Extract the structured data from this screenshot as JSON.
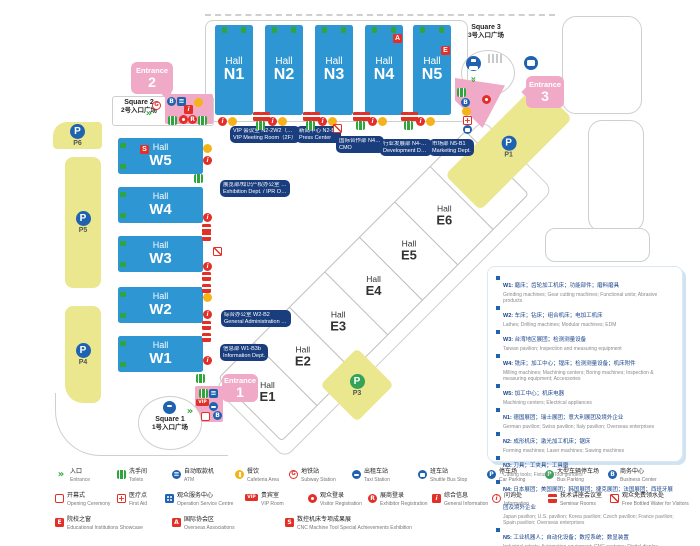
{
  "halls": {
    "n": [
      {
        "hall": "Hall",
        "code": "N1"
      },
      {
        "hall": "Hall",
        "code": "N2"
      },
      {
        "hall": "Hall",
        "code": "N3"
      },
      {
        "hall": "Hall",
        "code": "N4"
      },
      {
        "hall": "Hall",
        "code": "N5"
      }
    ],
    "w": [
      {
        "hall": "Hall",
        "code": "W5"
      },
      {
        "hall": "Hall",
        "code": "W4"
      },
      {
        "hall": "Hall",
        "code": "W3"
      },
      {
        "hall": "Hall",
        "code": "W2"
      },
      {
        "hall": "Hall",
        "code": "W1"
      }
    ],
    "e": [
      {
        "hall": "Hall",
        "code": "E1"
      },
      {
        "hall": "Hall",
        "code": "E2"
      },
      {
        "hall": "Hall",
        "code": "E3"
      },
      {
        "hall": "Hall",
        "code": "E4"
      },
      {
        "hall": "Hall",
        "code": "E5"
      },
      {
        "hall": "Hall",
        "code": "E6"
      },
      {
        "hall": "Hall",
        "code": "E7"
      }
    ]
  },
  "badges": {
    "n4": "A",
    "n5": "E",
    "w5": "S"
  },
  "entrances": [
    {
      "word": "Entrance",
      "num": "1"
    },
    {
      "word": "Entrance",
      "num": "2"
    },
    {
      "word": "Entrance",
      "num": "3"
    }
  ],
  "squares": [
    {
      "en": "Square 1",
      "cn": "1号入口广场"
    },
    {
      "en": "Square 2",
      "cn": "2号入口广场"
    },
    {
      "en": "Square 3",
      "cn": "3号入口广场"
    }
  ],
  "parking": [
    {
      "code": "P1"
    },
    {
      "code": "P3"
    },
    {
      "code": "P4"
    },
    {
      "code": "P5"
    },
    {
      "code": "P6"
    }
  ],
  "callouts": [
    {
      "cn": "VIP 会议室 N2-2W2（二层）",
      "en": "VIP Meeting Room（2F）"
    },
    {
      "cn": "新闻中心 N2-B1",
      "en": "Press Center"
    },
    {
      "cn": "国际合作部 N4-M4",
      "en": "CMO"
    },
    {
      "cn": "行业发展部 N4-B2c",
      "en": "Development Dept."
    },
    {
      "cn": "市场部 N5-B1",
      "en": "Marketing Dept."
    },
    {
      "cn": "展览部/知识产权办公室 W5-M8",
      "en": "Exhibition Dept. / IPR Office"
    },
    {
      "cn": "综合办公室 W2-B2",
      "en": "General Administration Office"
    },
    {
      "cn": "信息部 W1-B3b",
      "en": "Information Dept."
    }
  ],
  "info_panel": {
    "items": [
      {
        "code": "W1:",
        "cn": "磨床；齿轮加工机床；功能部件；磨料磨具",
        "en": "Grinding machines; Gear cutting machines; Functional units; Abrasive products"
      },
      {
        "code": "W2:",
        "cn": "车床；钻床；组合机床；电加工机床",
        "en": "Lathes; Drilling machines; Modular machines; EDM"
      },
      {
        "code": "W3:",
        "cn": "台湾地区展团；检测测量设备",
        "en": "Taiwan pavilion; Inspection and measuring equipment"
      },
      {
        "code": "W4:",
        "cn": "铣床；加工中心；镗床；检测测量设备；机床附件",
        "en": "Milling machines; Machining centers; Boring machines; Inspection & measuring equipment; Accessories"
      },
      {
        "code": "W5:",
        "cn": "加工中心；机床电器",
        "en": "Machining centers; Electrical appliances"
      },
      {
        "code": "N1:",
        "cn": "德国展团；瑞士展团；意大利展团及境外企业",
        "en": "German pavilion; Swiss pavilion; Italy pavilion; Overseas enterprises"
      },
      {
        "code": "N2:",
        "cn": "成形机床；激光加工机床；锯床",
        "en": "Forming machines; Laser machines; Sawing machines"
      },
      {
        "code": "N3:",
        "cn": "刀具；工夹具；工具磨",
        "en": "Cutting tools; Fixtures; Tool grinders"
      },
      {
        "code": "N4:",
        "cn": "日本展团；美国展团；韩国展团；捷克展团；法国展团；西班牙展团及境外企业",
        "en": "Japan pavilion; U.S. pavilion; Korea pavilion; Czech pavilion; France pavilion; Spain pavilion; Overseas enterprises"
      },
      {
        "code": "N5:",
        "cn": "工业机器人；自动化设备；数控系统；数显装置",
        "en": "Industrial robots; Automation equipment; CNC systems; Digital display"
      }
    ]
  },
  "legend": {
    "row1": [
      {
        "icon": "entrance-arrows",
        "cn": "入口",
        "en": "Entrance"
      },
      {
        "icon": "toilets",
        "cn": "洗手间",
        "en": "Toilets"
      },
      {
        "icon": "atm",
        "cn": "自动取款机",
        "en": "ATM"
      },
      {
        "icon": "cafeteria",
        "cn": "餐饮",
        "en": "Cafeteria Area"
      },
      {
        "icon": "subway",
        "cn": "地铁站",
        "en": "Subway Station"
      },
      {
        "icon": "taxi",
        "cn": "出租车站",
        "en": "Taxi Station"
      },
      {
        "icon": "shuttle-bus",
        "cn": "班车站",
        "en": "Shuttle Bus Stop"
      },
      {
        "icon": "car-parking",
        "cn": "停车场",
        "en": "Car Parking"
      },
      {
        "icon": "bus-parking",
        "cn": "大型车辆停车场",
        "en": "Bus Parking"
      },
      {
        "icon": "business-center",
        "cn": "商务中心",
        "en": "Business Center"
      }
    ],
    "row2": [
      {
        "icon": "opening-ceremony",
        "cn": "开幕式",
        "en": "Opening Ceremony"
      },
      {
        "icon": "first-aid",
        "cn": "医疗点",
        "en": "First Aid"
      },
      {
        "icon": "service-centre",
        "cn": "观众服务中心",
        "en": "Operation Service Centre"
      },
      {
        "icon": "vip-room",
        "cn": "贵宾室",
        "en": "VIP Room"
      },
      {
        "icon": "visitor-registration",
        "cn": "观众登录",
        "en": "Visitor Registration"
      },
      {
        "icon": "exhibitor-registration",
        "cn": "展商登录",
        "en": "Exhibitor Registration"
      },
      {
        "icon": "general-information",
        "cn": "综合信息",
        "en": "General Information"
      },
      {
        "icon": "information",
        "cn": "问询处",
        "en": "Information"
      },
      {
        "icon": "seminar-rooms",
        "cn": "技术讲座会议室",
        "en": "Seminar Rooms"
      },
      {
        "icon": "free-water",
        "cn": "观众免费领水处",
        "en": "Free Bottled Water for Visitors"
      }
    ],
    "row3": [
      {
        "icon": "educational",
        "cn": "院校之窗",
        "en": "Educational Institutions Showcase"
      },
      {
        "icon": "overseas-associations",
        "cn": "国际协会区",
        "en": "Overseas Associations"
      },
      {
        "icon": "cnc-achievements",
        "cn": "数控机床专项成果展",
        "en": "CNC Machine Tool Special Achievements Exhibition"
      }
    ]
  },
  "icons": {
    "entrance-arrows": "»",
    "toilets": "wc-figures",
    "atm": "≡",
    "cafeteria": "fork",
    "subway": "G",
    "taxi": "car",
    "shuttle-bus": "bus",
    "car-parking": "P",
    "bus-parking": "P",
    "business-center": "B",
    "opening-ceremony": "frame",
    "first-aid": "+",
    "service-centre": "people",
    "vip-room": "VIP",
    "visitor-registration": "person",
    "exhibitor-registration": "R",
    "general-information": "i",
    "information": "i",
    "seminar-rooms": "bar",
    "free-water": "slash",
    "educational": "E",
    "overseas-associations": "A",
    "cnc-achievements": "S"
  }
}
